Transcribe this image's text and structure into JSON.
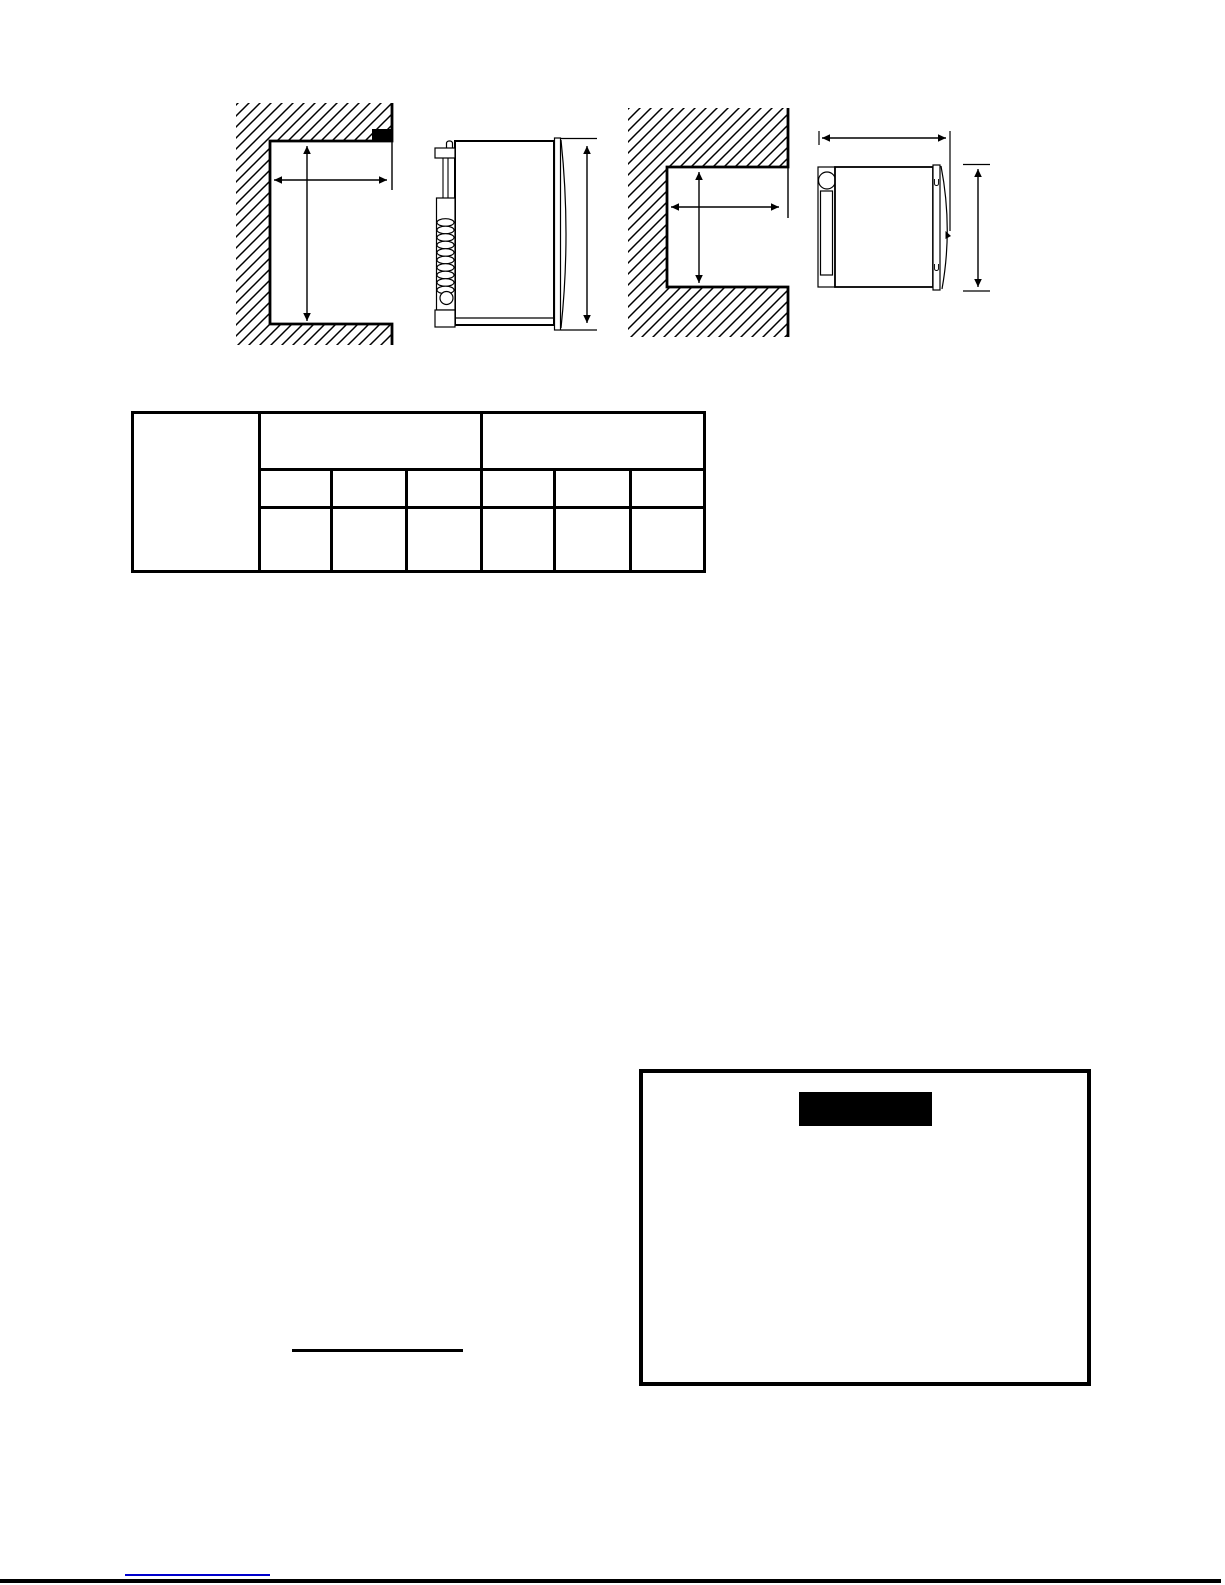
{
  "page": {
    "background_color": "#ffffff",
    "ink_color": "#000000",
    "link_color": "#0000cc",
    "notice_banner_color": "#000000"
  },
  "clearance_table": {
    "corner_header": "",
    "group_headers": [
      "",
      ""
    ],
    "column_headers": [
      "",
      "",
      "",
      "",
      "",
      ""
    ],
    "data_cells": [
      "",
      "",
      "",
      "",
      "",
      ""
    ]
  },
  "notice_box": {
    "banner_label": "",
    "body_text": ""
  },
  "annotations": {
    "underlined_phrase": ""
  },
  "footer": {
    "link_label": ""
  }
}
